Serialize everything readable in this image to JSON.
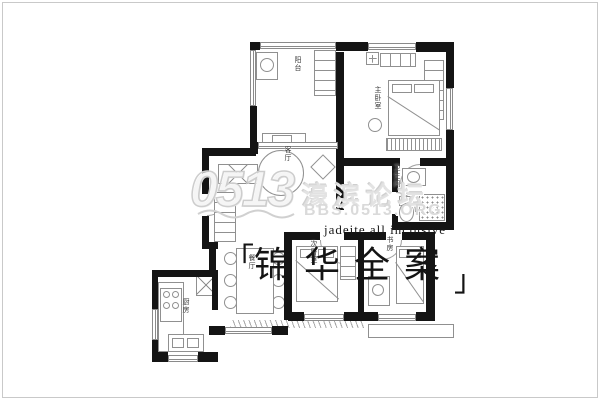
{
  "watermark": {
    "logo_number": "0513",
    "forum_name": "濠滨论坛",
    "forum_url": "BBS.0513.ORG"
  },
  "brand": {
    "bracket_left": "「",
    "name": "锦华全案",
    "bracket_right": "」",
    "tagline_en": "jadeite all inclusive"
  },
  "rooms": {
    "balcony": "阳台",
    "master_bedroom": "主卧室",
    "living_room": "客厅",
    "bathroom": "卫生间",
    "dining_room": "餐厅",
    "kitchen": "厨房",
    "second_bedroom": "次卧室",
    "study": "书房"
  },
  "colors": {
    "wall": "#141414",
    "furniture_line": "#909090",
    "watermark_gray": "#d6d6d6",
    "brand_text": "#1a1a1a"
  }
}
